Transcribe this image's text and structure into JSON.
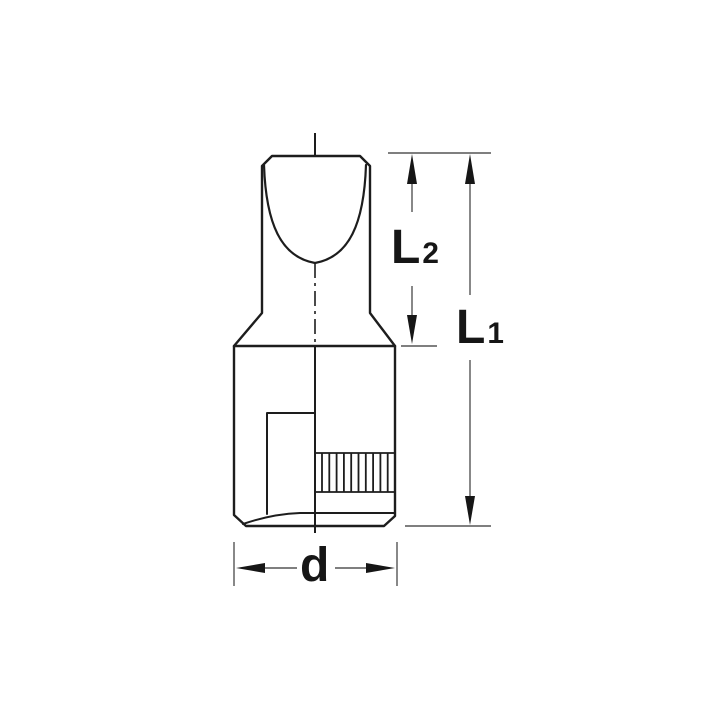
{
  "drawing": {
    "description": "Technical line drawing of a slotted (flat-blade) screwdriver socket bit shown in half section with knurled band, centerline and dimension callouts",
    "background_color": "#ffffff",
    "outline_color": "#1d1d1d",
    "dimension_color": "#555555",
    "label_color": "#161616",
    "labels": {
      "l2": {
        "main": "L",
        "sub": "2"
      },
      "l1": {
        "main": "L",
        "sub": "1"
      },
      "d": {
        "main": "d",
        "sub": ""
      }
    }
  }
}
